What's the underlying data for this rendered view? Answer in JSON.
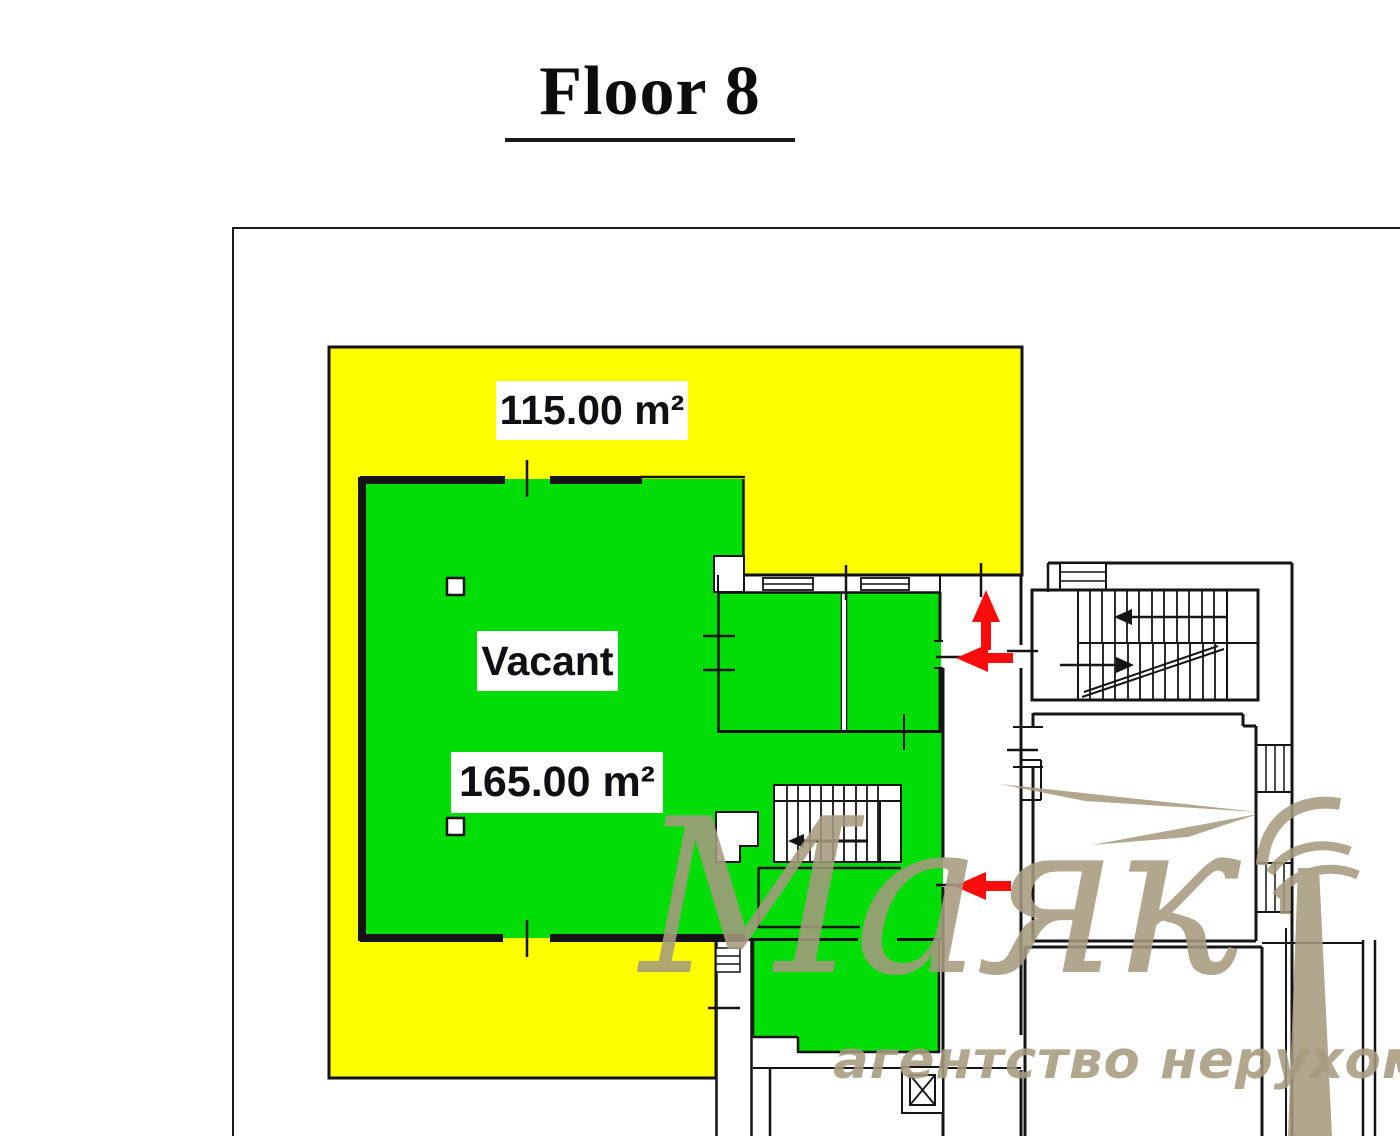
{
  "page": {
    "title": "Floor 8"
  },
  "plan": {
    "yellow_area": {
      "label": "115.00 m²",
      "color": "#ffff00",
      "border_color": "#111111"
    },
    "green_area": {
      "status_label": "Vacant",
      "label": "165.00 m²",
      "color": "#00dd07",
      "border_color": "#111111"
    },
    "walls_color": "#141414",
    "arrows": {
      "color": "#fb0d0d",
      "directions": [
        "up",
        "left",
        "left"
      ]
    },
    "symbols": [
      "staircase",
      "staircase",
      "elevator",
      "windows",
      "columns"
    ]
  },
  "watermark": {
    "brand": "Маяк",
    "tagline": "агентство нерухомості",
    "color": "#a69b7f",
    "logo": "lighthouse-with-beams"
  }
}
